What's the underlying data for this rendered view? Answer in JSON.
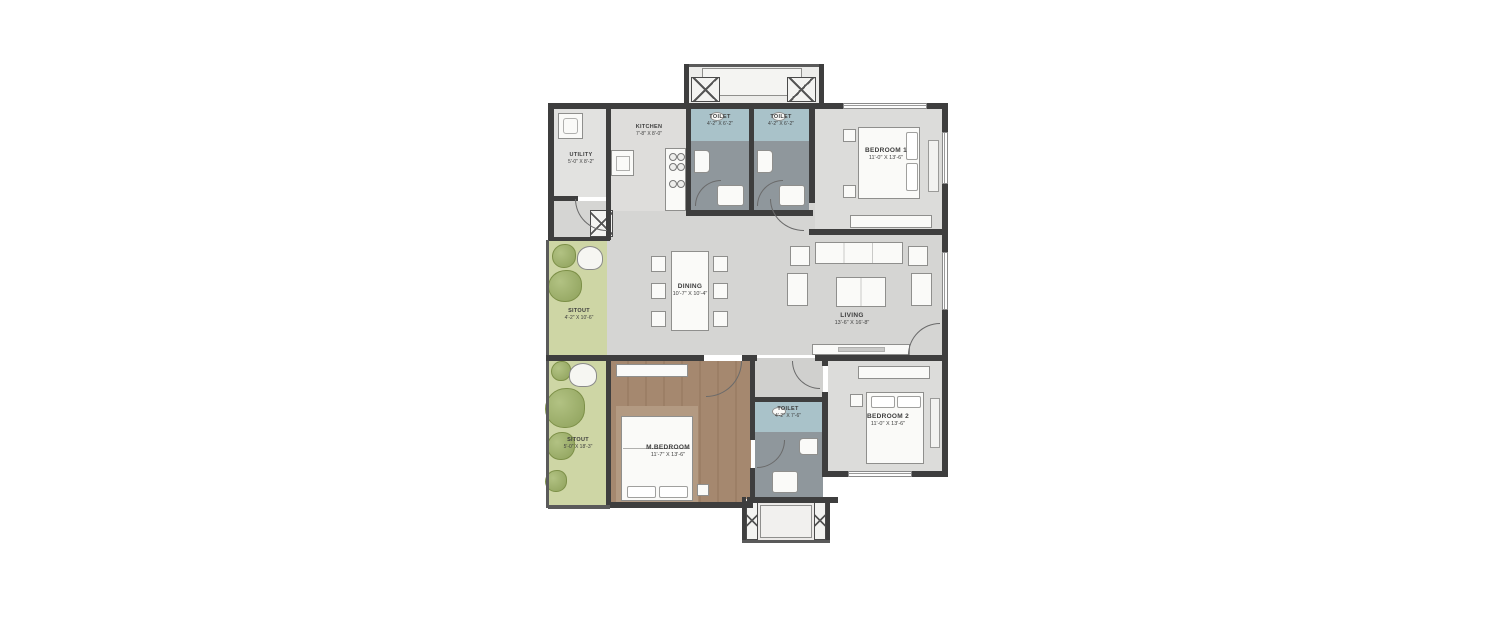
{
  "plan": {
    "type": "apartment-floor-plan",
    "colors": {
      "wall": "#3e3e3e",
      "floor_gray": "#d6d6d4",
      "bedroom_floor": "#dcdcda",
      "toilet_top": "#a9c2c9",
      "toilet_floor": "#8f979c",
      "master_wood": "#a5886f",
      "sitout_green": "#ced6a5",
      "background": "#ffffff"
    },
    "rooms": [
      {
        "id": "utility",
        "name": "UTILITY",
        "dims": "5'-0\" X 8'-2\""
      },
      {
        "id": "kitchen",
        "name": "KITCHEN",
        "dims": "7'-8\" X 8'-0\""
      },
      {
        "id": "toilet-1",
        "name": "TOILET",
        "dims": "4'-2\" X 6'-2\""
      },
      {
        "id": "toilet-2",
        "name": "TOILET",
        "dims": "4'-2\" X 6'-2\""
      },
      {
        "id": "bedroom-1",
        "name": "BEDROOM 1",
        "dims": "11'-0\" X 13'-6\""
      },
      {
        "id": "sitout-upper",
        "name": "SITOUT",
        "dims": "4'-2\" X 10'-6\""
      },
      {
        "id": "dining",
        "name": "DINING",
        "dims": "10'-7\" X 10'-4\""
      },
      {
        "id": "living",
        "name": "LIVING",
        "dims": "13'-6\" X 16'-8\""
      },
      {
        "id": "sitout-lower",
        "name": "SITOUT",
        "dims": "5'-0\" X 18'-3\""
      },
      {
        "id": "m-bedroom",
        "name": "M.BEDROOM",
        "dims": "11'-7\" X 13'-6\""
      },
      {
        "id": "toilet-3",
        "name": "TOILET",
        "dims": "4'-2\" X 7'-6\""
      },
      {
        "id": "bedroom-2",
        "name": "BEDROOM 2",
        "dims": "11'-0\" X 13'-6\""
      }
    ]
  }
}
